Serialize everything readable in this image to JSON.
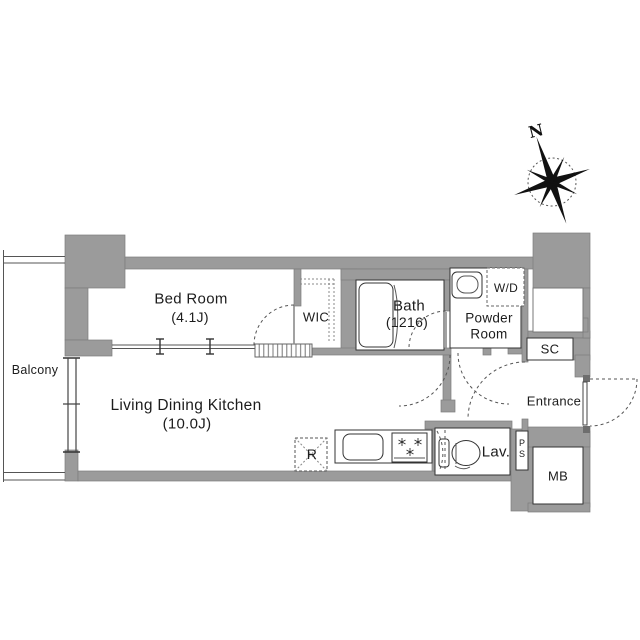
{
  "compass": {
    "north_label": "N"
  },
  "rooms": {
    "balcony": {
      "label": "Balcony"
    },
    "bed_room": {
      "label": "Bed Room",
      "size": "(4.1J)"
    },
    "wic": {
      "label": "WIC"
    },
    "bath": {
      "label": "Bath",
      "size": "(1216)"
    },
    "powder_room": {
      "line1": "Powder",
      "line2": "Room"
    },
    "living_dining_kitchen": {
      "label": "Living Dining Kitchen",
      "size": "(10.0J)"
    },
    "entrance": {
      "label": "Entrance"
    },
    "lavatory": {
      "label": "Lav."
    }
  },
  "fixtures": {
    "washer_dryer": {
      "label": "W/D"
    },
    "shoe_closet": {
      "label": "SC"
    },
    "pipe_space": {
      "label": "PS"
    },
    "meter_box": {
      "label": "MB"
    },
    "refrigerator": {
      "label": "R"
    }
  },
  "colors": {
    "wall": "#9b9b9b",
    "wall_edge": "#7d7d7d",
    "line": "#333333",
    "bg": "#ffffff"
  }
}
